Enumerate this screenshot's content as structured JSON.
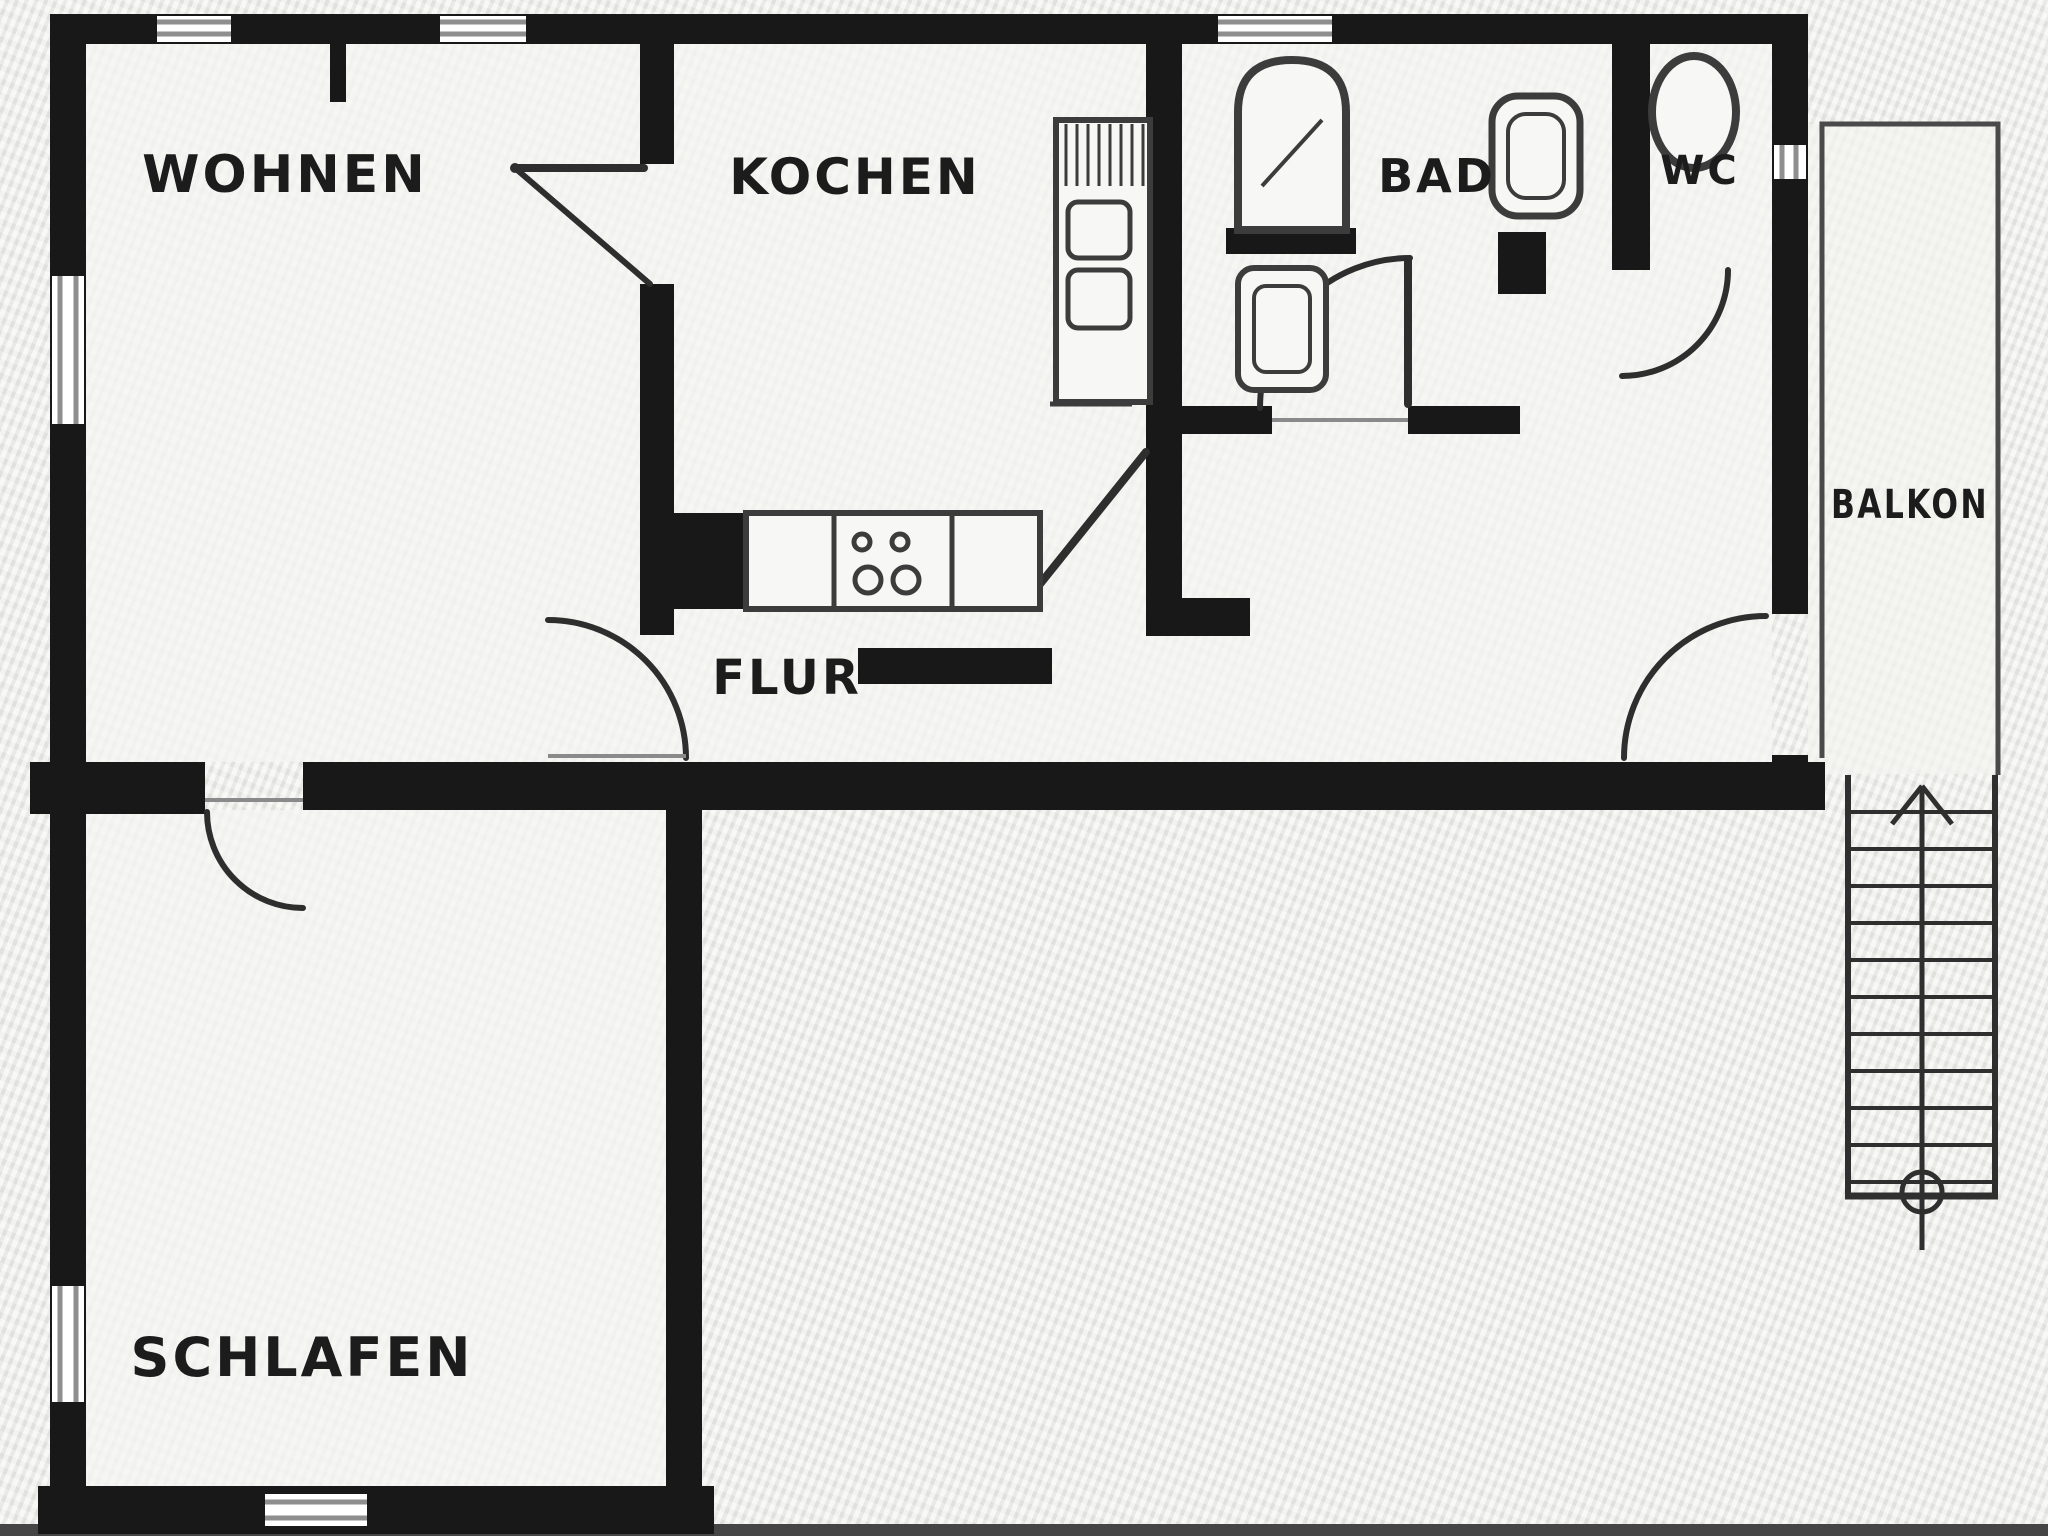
{
  "meta": {
    "document_kind": "scanned apartment floor plan",
    "language": "de"
  },
  "colors": {
    "wall": "#181818",
    "door": "#2e2e2e",
    "fixture": "#3c3c3c",
    "thin": "#4a4a4a",
    "window": "#8e8e8e",
    "background": "#e9e9e6",
    "floor": "#f5f5f2",
    "label": "#1c1c1c",
    "scan_strip": "#454545"
  },
  "rooms": {
    "wohnen": {
      "label": "WOHNEN"
    },
    "kochen": {
      "label": "KOCHEN"
    },
    "bad": {
      "label": "BAD"
    },
    "wc": {
      "label": "WC"
    },
    "balkon": {
      "label": "BALKON"
    },
    "flur": {
      "label": "FLUR"
    },
    "schlafen": {
      "label": "SCHLAFEN"
    }
  },
  "fixtures": [
    "shower-tub",
    "washbasin",
    "bad-toilet",
    "wc-toilet",
    "kitchen-tall-cabinet",
    "kitchen-counter",
    "stove-burners",
    "external-staircase",
    "stair-direction-arrow",
    "stair-start-circle",
    "balcony-railing"
  ],
  "doors": [
    "wohnen-kochen-door",
    "flur-wohnen-door",
    "schlafen-door",
    "bad-door",
    "wc-door",
    "balcony-door",
    "hall-diagonal-door"
  ]
}
